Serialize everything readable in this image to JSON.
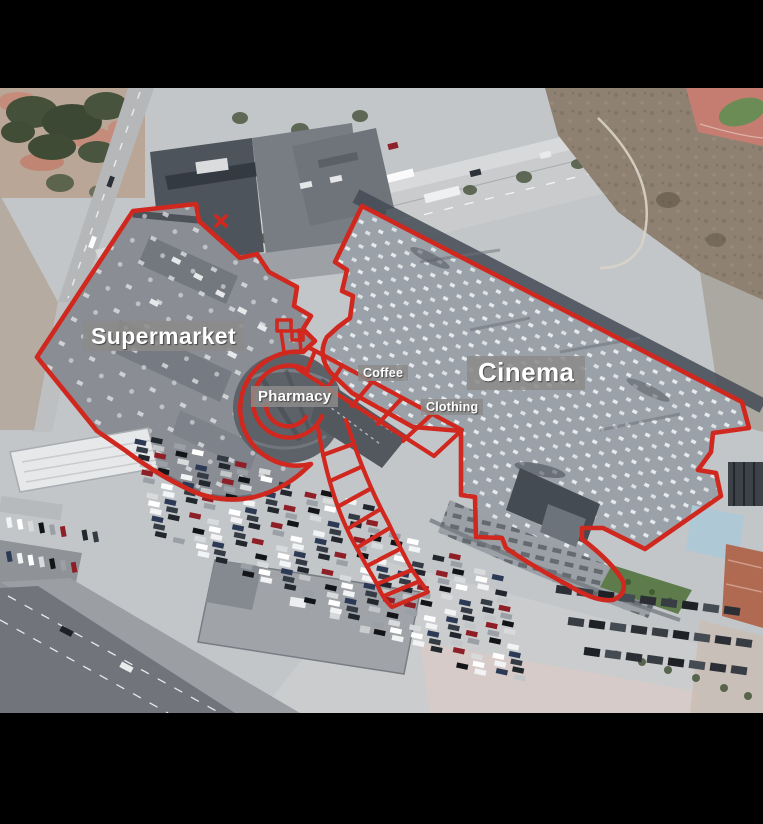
{
  "annotation": {
    "outline_color": "#d0281f",
    "label_bg": "#8a8a88",
    "label_text_color": "#ffffff",
    "areas": {
      "supermarket": {
        "label": "Supermarket"
      },
      "cinema": {
        "label": "Cinema"
      },
      "pharmacy": {
        "label": "Pharmacy"
      },
      "coffee": {
        "label": "Coffee"
      },
      "clothing": {
        "label": "Clothing"
      }
    }
  },
  "letterbox_color": "#000000"
}
